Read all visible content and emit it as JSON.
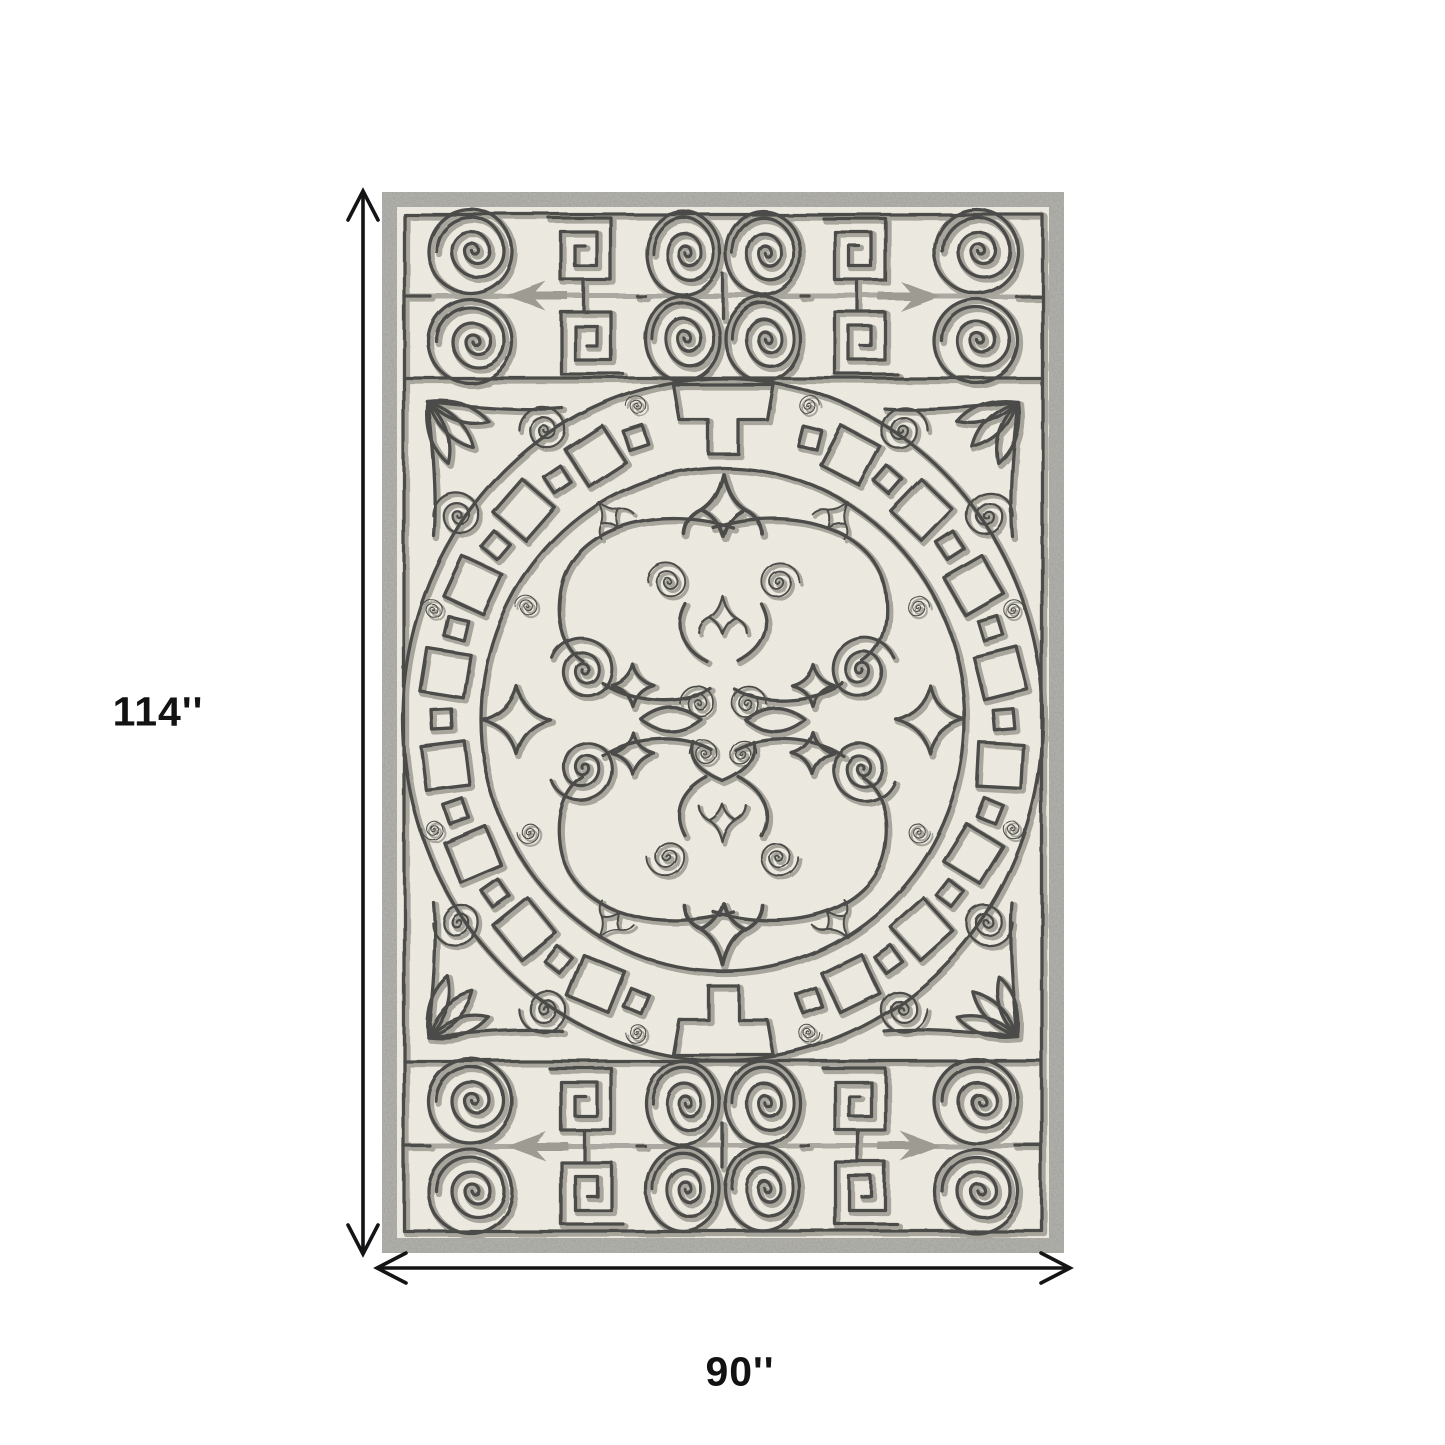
{
  "figure": {
    "type": "product-dimension-diagram",
    "product_alt": "Ivory and grey hand-hooked area rug with Greek key border bands and circular fretwork medallion with scroll damask center",
    "height_label": "114''",
    "width_label": "90''",
    "colors": {
      "background": "#ffffff",
      "rug_border": "#9b9b95",
      "rug_field": "#ece9e0",
      "pattern_dark": "#4b4b49",
      "pattern_light": "#a8a69c",
      "dimension_line": "#141414"
    }
  }
}
